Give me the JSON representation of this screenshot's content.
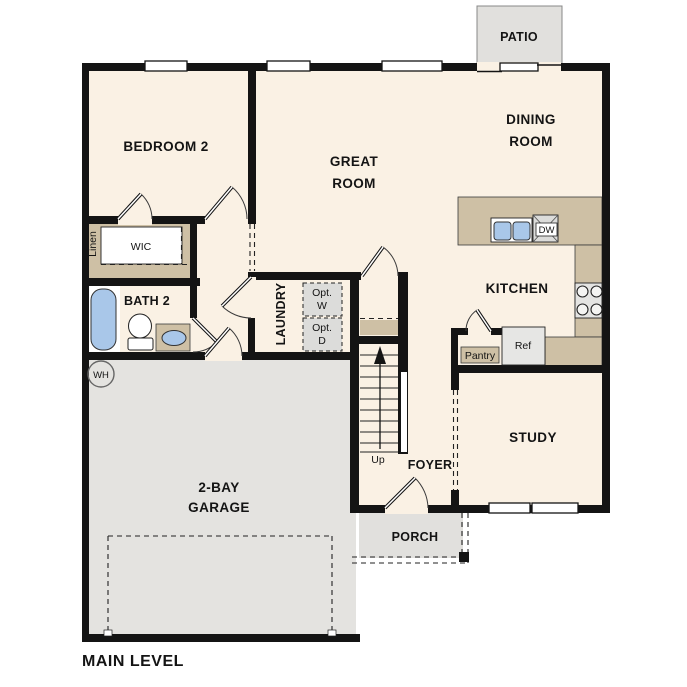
{
  "plan": {
    "title": "MAIN LEVEL"
  },
  "rooms": {
    "bedroom2": {
      "label": "BEDROOM 2"
    },
    "great_room": {
      "line1": "GREAT",
      "line2": "ROOM"
    },
    "dining_room": {
      "line1": "DINING",
      "line2": "ROOM"
    },
    "kitchen": {
      "label": "KITCHEN"
    },
    "study": {
      "label": "STUDY"
    },
    "garage": {
      "line1": "2-BAY",
      "line2": "GARAGE"
    },
    "bath2": {
      "label": "BATH 2"
    },
    "laundry": {
      "label": "LAUNDRY"
    },
    "foyer": {
      "label": "FOYER"
    },
    "porch": {
      "label": "PORCH"
    },
    "patio": {
      "label": "PATIO"
    },
    "wic": {
      "label": "WIC"
    },
    "linen": {
      "label": "Linen"
    },
    "pantry": {
      "label": "Pantry"
    }
  },
  "fixtures": {
    "refrigerator": "Ref",
    "dishwasher": "DW",
    "water_heater": "WH",
    "optional_washer": {
      "line1": "Opt.",
      "line2": "W"
    },
    "optional_dryer": {
      "line1": "Opt.",
      "line2": "D"
    },
    "stairs_direction": "Up"
  },
  "colors": {
    "floor": "#faf1e4",
    "counter_tan": "#cec0a5",
    "garage_gray": "#e4e3e0",
    "porch_gray": "#e1e0dd",
    "fixture_blue": "#a9c7e9",
    "wall_black": "#141414"
  }
}
